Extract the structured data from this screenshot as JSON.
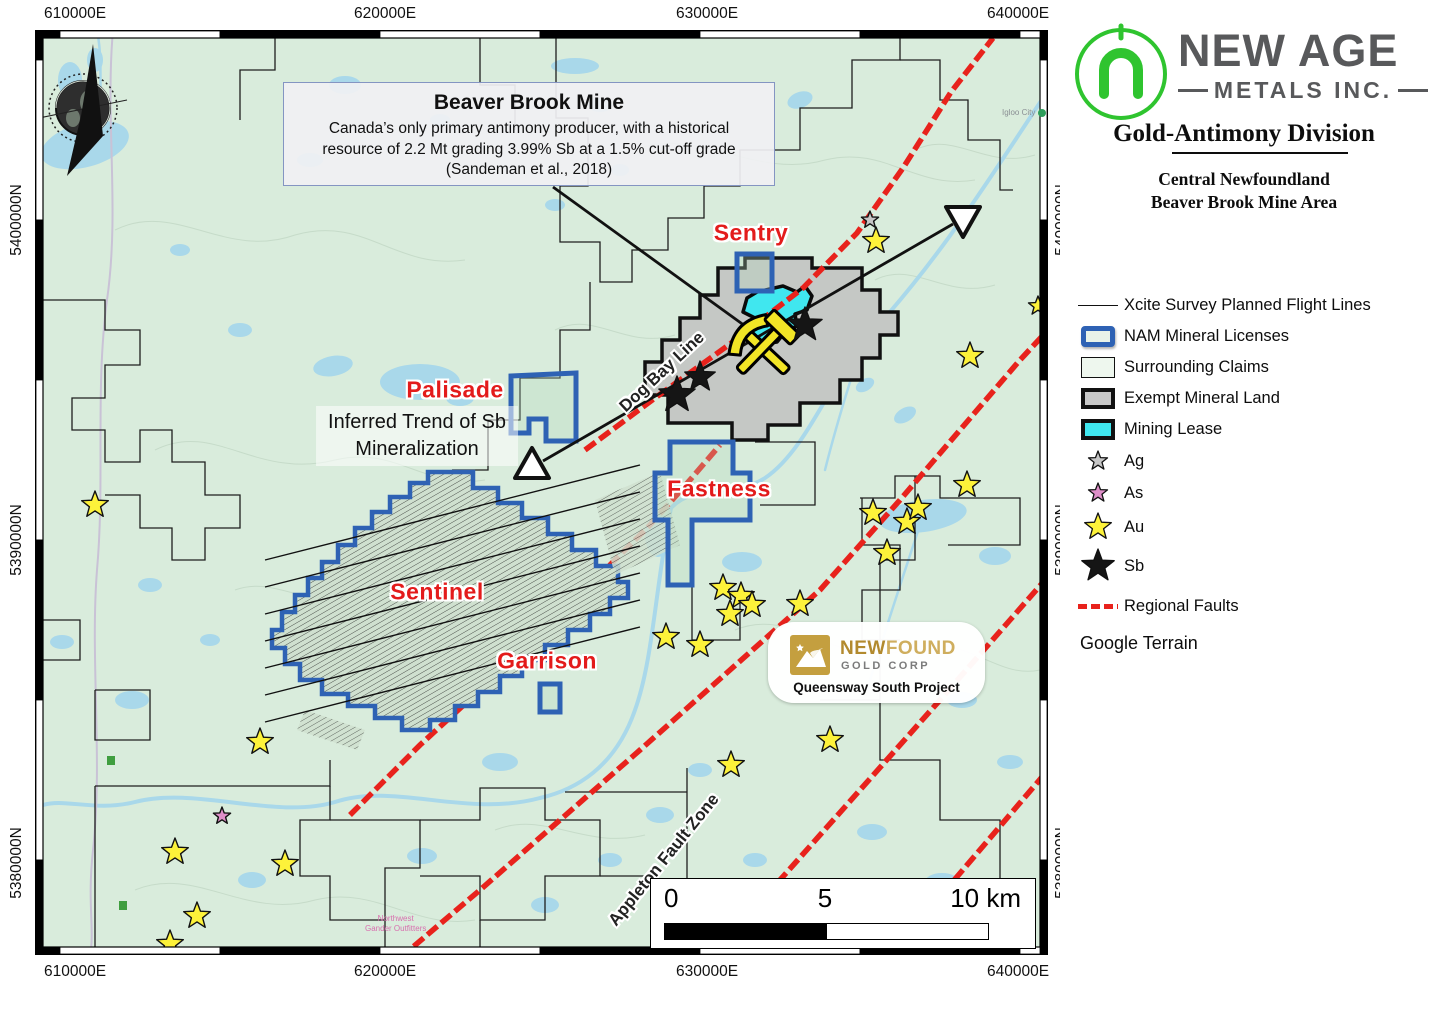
{
  "panel": {
    "brand": {
      "name_top": "NEW AGE",
      "name_bottom": "METALS INC."
    },
    "division_title": "Gold-Antimony Division",
    "area_line1": "Central Newfoundland",
    "area_line2": "Beaver Brook Mine Area",
    "legend": [
      {
        "label": "Xcite Survey Planned Flight Lines",
        "type": "line"
      },
      {
        "label": "NAM Mineral Licenses",
        "type": "nam"
      },
      {
        "label": "Surrounding Claims",
        "type": "claims"
      },
      {
        "label": "Exempt Mineral Land",
        "type": "exempt"
      },
      {
        "label": "Mining Lease",
        "type": "lease"
      },
      {
        "label": "Ag",
        "type": "star-ag"
      },
      {
        "label": "As",
        "type": "star-as"
      },
      {
        "label": "Au",
        "type": "star-au"
      },
      {
        "label": "Sb",
        "type": "star-sb"
      },
      {
        "label": "Regional Faults",
        "type": "fault"
      }
    ],
    "basemap": "Google Terrain"
  },
  "map": {
    "axis": {
      "top": [
        "610000E",
        "620000E",
        "630000E",
        "640000E"
      ],
      "bottom": [
        "610000E",
        "620000E",
        "630000E",
        "640000E"
      ],
      "left": [
        "5400000N",
        "5390000N",
        "5380000N"
      ],
      "right": [
        "5400000N",
        "5390000N",
        "5380000N"
      ]
    },
    "callout": {
      "title": "Beaver Brook Mine",
      "body": "Canada’s only primary antimony producer, with a historical resource of 2.2 Mt grading 3.99% Sb at a 1.5% cut-off grade (Sandeman et al., 2018)"
    },
    "labels": {
      "sentry": "Sentry",
      "palisade": "Palisade",
      "fastness": "Fastness",
      "sentinel": "Sentinel",
      "garrison": "Garrison",
      "dog_bay": "Dog Bay Line",
      "appleton": "Appleton Fault Zone",
      "trend_line1": "Inferred Trend of Sb",
      "trend_line2": "Mineralization",
      "igloo_city": "Igloo City",
      "outfitters_line1": "Northwest",
      "outfitters_line2": "Gander Outfitters"
    },
    "scalebar": {
      "t0": "0",
      "t5": "5",
      "t10": "10 km"
    },
    "newfound": {
      "brand_bold": "NEW",
      "brand_rest": "FOUND",
      "subtitle": "GOLD CORP",
      "project": "Queensway South Project"
    },
    "colors": {
      "terrain": "#d9ecdc",
      "water": "#a9d8ea",
      "fault": "#e8221c",
      "nam_blue": "#2e62b4",
      "exempt_fill": "#c5c8c5",
      "lease_fill": "#40e7ef",
      "au": "#fdf23a",
      "ag": "#c6c6c6",
      "as": "#df8fc9",
      "sb": "#151515",
      "red_label": "#e31b1b"
    },
    "markers": {
      "au": [
        [
          60,
          475
        ],
        [
          225,
          712
        ],
        [
          140,
          822
        ],
        [
          162,
          886
        ],
        [
          135,
          914
        ],
        [
          250,
          834
        ],
        [
          631,
          607
        ],
        [
          665,
          615
        ],
        [
          688,
          558
        ],
        [
          706,
          566
        ],
        [
          717,
          575
        ],
        [
          695,
          584
        ],
        [
          765,
          574
        ],
        [
          696,
          735
        ],
        [
          795,
          710
        ],
        [
          838,
          483
        ],
        [
          872,
          492
        ],
        [
          883,
          478
        ],
        [
          932,
          455
        ],
        [
          852,
          523
        ],
        [
          841,
          211
        ],
        [
          935,
          326
        ],
        [
          1003,
          276,
          10
        ],
        [
          813,
          908
        ]
      ],
      "ag": [
        [
          835,
          190
        ]
      ],
      "as": [
        [
          187,
          786
        ]
      ],
      "sb": [
        [
          642,
          365,
          19
        ],
        [
          665,
          347,
          16
        ],
        [
          770,
          295,
          18
        ]
      ]
    },
    "faults": [
      [
        [
          550,
          420
        ],
        [
          620,
          368
        ],
        [
          695,
          314
        ],
        [
          768,
          258
        ],
        [
          822,
          203
        ],
        [
          868,
          138
        ],
        [
          916,
          62
        ],
        [
          958,
          8
        ]
      ],
      [
        [
          365,
          928
        ],
        [
          445,
          860
        ],
        [
          525,
          790
        ],
        [
          605,
          720
        ],
        [
          695,
          640
        ],
        [
          785,
          560
        ],
        [
          865,
          470
        ],
        [
          925,
          400
        ],
        [
          985,
          330
        ],
        [
          1013,
          300
        ]
      ],
      [
        [
          665,
          928
        ],
        [
          745,
          850
        ],
        [
          825,
          760
        ],
        [
          905,
          670
        ],
        [
          975,
          590
        ],
        [
          1010,
          550
        ]
      ],
      [
        [
          845,
          928
        ],
        [
          915,
          855
        ],
        [
          1013,
          740
        ]
      ],
      [
        [
          315,
          785
        ],
        [
          385,
          715
        ],
        [
          445,
          660
        ],
        [
          505,
          600
        ],
        [
          565,
          545
        ],
        [
          615,
          495
        ],
        [
          655,
          450
        ],
        [
          685,
          415
        ]
      ]
    ],
    "lakes": [
      [
        50,
        115,
        45,
        22,
        -15
      ],
      [
        310,
        55,
        16,
        9,
        0
      ],
      [
        540,
        36,
        24,
        8,
        0
      ],
      [
        565,
        75,
        12,
        7,
        0
      ],
      [
        765,
        70,
        13,
        8,
        -20
      ],
      [
        888,
        486,
        44,
        16,
        -8
      ],
      [
        960,
        526,
        16,
        9,
        0
      ],
      [
        623,
        505,
        13,
        22,
        0
      ],
      [
        707,
        532,
        20,
        10,
        0
      ],
      [
        385,
        352,
        40,
        18,
        0
      ],
      [
        298,
        336,
        20,
        10,
        -10
      ],
      [
        425,
        368,
        14,
        8,
        0
      ],
      [
        465,
        732,
        18,
        9,
        0
      ],
      [
        645,
        875,
        26,
        12,
        -5
      ],
      [
        713,
        905,
        15,
        8,
        0
      ],
      [
        217,
        850,
        14,
        8,
        0
      ],
      [
        387,
        826,
        15,
        8,
        0
      ],
      [
        97,
        670,
        17,
        9,
        0
      ],
      [
        27,
        612,
        12,
        7,
        0
      ],
      [
        927,
        670,
        15,
        8,
        0
      ],
      [
        975,
        732,
        13,
        7,
        0
      ],
      [
        837,
        802,
        15,
        8,
        0
      ],
      [
        907,
        852,
        17,
        9,
        0
      ],
      [
        35,
        50,
        12,
        18,
        0
      ],
      [
        60,
        30,
        8,
        12,
        0
      ],
      [
        145,
        220,
        10,
        6,
        0
      ],
      [
        205,
        300,
        12,
        7,
        0
      ],
      [
        520,
        175,
        10,
        6,
        0
      ],
      [
        585,
        140,
        9,
        6,
        0
      ],
      [
        830,
        355,
        10,
        6,
        -30
      ],
      [
        870,
        385,
        12,
        7,
        -30
      ],
      [
        115,
        555,
        12,
        7,
        0
      ],
      [
        175,
        610,
        10,
        6,
        0
      ],
      [
        720,
        830,
        12,
        7,
        0
      ],
      [
        510,
        875,
        14,
        8,
        0
      ],
      [
        575,
        830,
        12,
        7,
        0
      ],
      [
        625,
        785,
        14,
        8,
        0
      ],
      [
        665,
        740,
        12,
        7,
        0
      ],
      [
        275,
        130,
        13,
        7,
        0
      ],
      [
        405,
        90,
        10,
        6,
        0
      ]
    ]
  }
}
